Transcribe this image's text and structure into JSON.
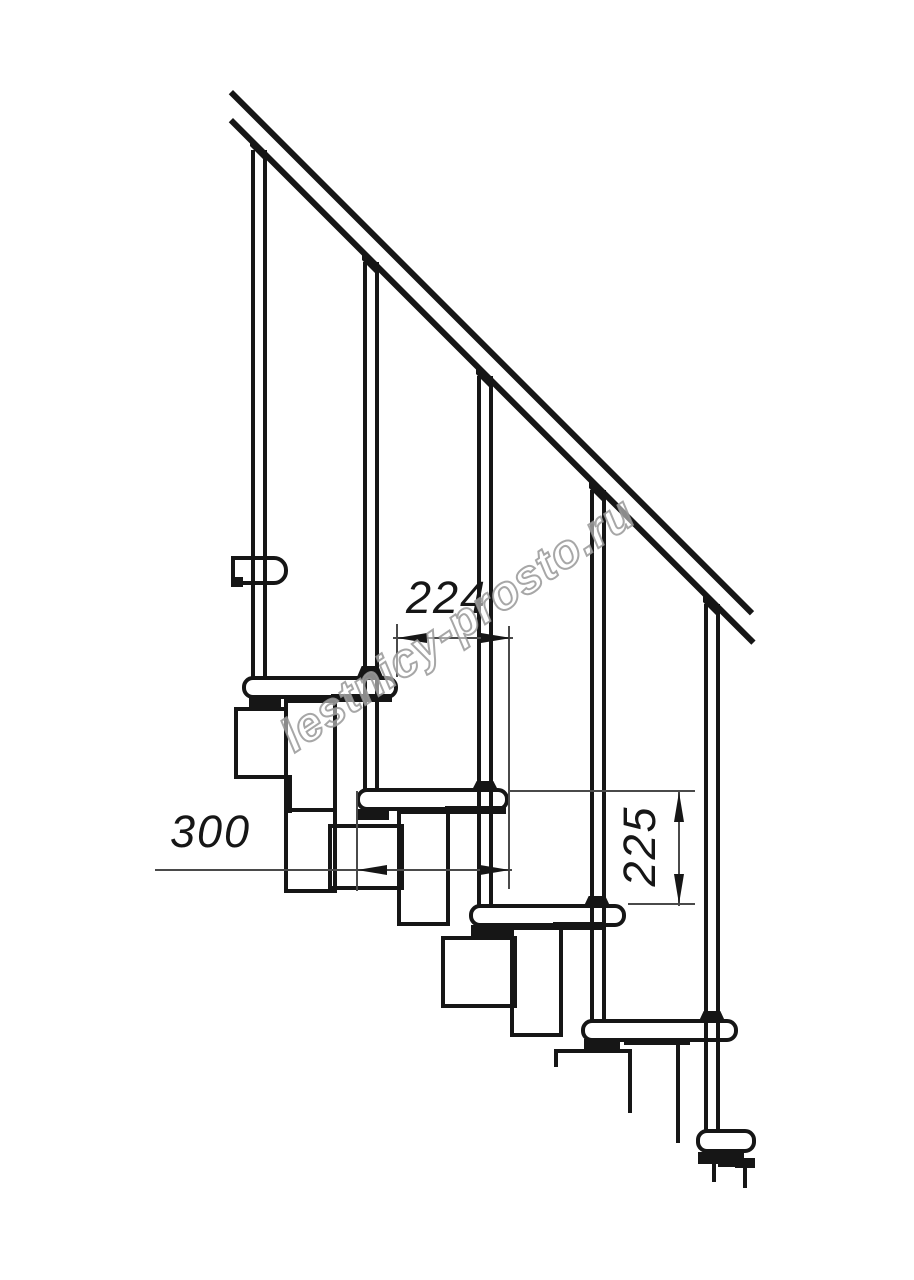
{
  "title": "Modular staircase side elevation drawing",
  "watermark": {
    "text": "lestnicy-prosto.ru",
    "outline_color": "#989898",
    "fill_color": "#ffffff"
  },
  "dimensions": {
    "run_label": "224",
    "depth_label": "300",
    "rise_label": "225",
    "run_meaning": "step run between tread noses (mm)",
    "depth_meaning": "tread depth (mm)",
    "rise_meaning": "step rise between treads (mm)"
  },
  "colors": {
    "ink": "#161616",
    "dim_line": "#4a4a4a",
    "background": "#ffffff"
  },
  "chart_data": {
    "type": "table",
    "title": "Staircase drawing dimensions",
    "categories": [
      "step run",
      "tread depth",
      "step rise"
    ],
    "values": [
      224,
      300,
      225
    ]
  },
  "drawing": {
    "shapes": [
      {
        "n": "handrail-upper-line",
        "t": "line",
        "x": 233,
        "y": 90,
        "w": 737,
        "h": 6,
        "rot": 45
      },
      {
        "n": "handrail-lower-line",
        "t": "line",
        "x": 233,
        "y": 118,
        "w": 739,
        "h": 6,
        "rot": 45
      },
      {
        "n": "baluster-1-left-line",
        "t": "line",
        "x": 251,
        "y": 150,
        "w": 4,
        "h": 527
      },
      {
        "n": "baluster-1-right-line",
        "t": "line",
        "x": 263,
        "y": 150,
        "w": 4,
        "h": 527
      },
      {
        "n": "baluster-2-left-line",
        "t": "line",
        "x": 363,
        "y": 262,
        "w": 4,
        "h": 527
      },
      {
        "n": "baluster-2-right-line",
        "t": "line",
        "x": 375,
        "y": 262,
        "w": 4,
        "h": 527
      },
      {
        "n": "baluster-3-left-line",
        "t": "line",
        "x": 477,
        "y": 376,
        "w": 4,
        "h": 529
      },
      {
        "n": "baluster-3-right-line",
        "t": "line",
        "x": 489,
        "y": 376,
        "w": 4,
        "h": 529
      },
      {
        "n": "baluster-4-left-line",
        "t": "line",
        "x": 590,
        "y": 490,
        "w": 4,
        "h": 530
      },
      {
        "n": "baluster-4-right-line",
        "t": "line",
        "x": 602,
        "y": 490,
        "w": 4,
        "h": 530
      },
      {
        "n": "baluster-5-left-line",
        "t": "line",
        "x": 704,
        "y": 604,
        "w": 4,
        "h": 526
      },
      {
        "n": "baluster-5-right-line",
        "t": "line",
        "x": 716,
        "y": 604,
        "w": 4,
        "h": 526
      },
      {
        "n": "baluster-1-rail-cap",
        "t": "line",
        "x": 250,
        "y": 137,
        "w": 17,
        "h": 9,
        "skew": 45
      },
      {
        "n": "baluster-2-rail-cap",
        "t": "line",
        "x": 362,
        "y": 251,
        "w": 17,
        "h": 9,
        "skew": 45
      },
      {
        "n": "baluster-3-rail-cap",
        "t": "line",
        "x": 476,
        "y": 365,
        "w": 17,
        "h": 9,
        "skew": 45
      },
      {
        "n": "baluster-4-rail-cap",
        "t": "line",
        "x": 589,
        "y": 479,
        "w": 17,
        "h": 9,
        "skew": 45
      },
      {
        "n": "baluster-5-rail-cap",
        "t": "line",
        "x": 703,
        "y": 593,
        "w": 17,
        "h": 9,
        "skew": 45
      },
      {
        "n": "rail-bracket-post1",
        "t": "out",
        "x": 231,
        "y": 556,
        "w": 57,
        "h": 29,
        "r": "0 14px 14px 0"
      },
      {
        "n": "rail-bracket-notch",
        "t": "line",
        "x": 231,
        "y": 577,
        "w": 12,
        "h": 10
      },
      {
        "n": "floor-slab-top-edge",
        "t": "line",
        "x": 234,
        "y": 707,
        "w": 50,
        "h": 4
      },
      {
        "n": "floor-slab-left-edge",
        "t": "line",
        "x": 234,
        "y": 707,
        "w": 4,
        "h": 72
      },
      {
        "n": "floor-slab-bottom-edge",
        "t": "line",
        "x": 234,
        "y": 775,
        "w": 58,
        "h": 4
      },
      {
        "n": "floor-slab-right-edge",
        "t": "line",
        "x": 288,
        "y": 775,
        "w": 4,
        "h": 38
      },
      {
        "n": "tread-1",
        "t": "out",
        "x": 242,
        "y": 676,
        "w": 156,
        "h": 23,
        "r": "11px"
      },
      {
        "n": "tread-2",
        "t": "out",
        "x": 356,
        "y": 788,
        "w": 153,
        "h": 23,
        "r": "11px"
      },
      {
        "n": "tread-3",
        "t": "out",
        "x": 469,
        "y": 904,
        "w": 157,
        "h": 23,
        "r": "11px"
      },
      {
        "n": "tread-4",
        "t": "out",
        "x": 581,
        "y": 1019,
        "w": 157,
        "h": 23,
        "r": "11px"
      },
      {
        "n": "tread-5-bottom",
        "t": "out",
        "x": 696,
        "y": 1129,
        "w": 60,
        "h": 24,
        "r": "11px"
      },
      {
        "n": "module-column-1",
        "t": "out",
        "x": 284,
        "y": 699,
        "w": 53,
        "h": 194
      },
      {
        "n": "module-column-1-joint",
        "t": "line",
        "x": 286,
        "y": 808,
        "w": 49,
        "h": 4
      },
      {
        "n": "module-box-1",
        "t": "out",
        "x": 328,
        "y": 824,
        "w": 76,
        "h": 66
      },
      {
        "n": "module-column-2",
        "t": "out",
        "x": 397,
        "y": 810,
        "w": 53,
        "h": 116
      },
      {
        "n": "module-box-2",
        "t": "out",
        "x": 441,
        "y": 936,
        "w": 76,
        "h": 72
      },
      {
        "n": "module-column-3",
        "t": "out",
        "x": 510,
        "y": 926,
        "w": 53,
        "h": 111
      },
      {
        "n": "module-box-3-top-edge",
        "t": "line",
        "x": 554,
        "y": 1049,
        "w": 78,
        "h": 4
      },
      {
        "n": "module-box-3-right-edge",
        "t": "line",
        "x": 628,
        "y": 1049,
        "w": 4,
        "h": 64
      },
      {
        "n": "module-box-3-left-stub",
        "t": "line",
        "x": 554,
        "y": 1049,
        "w": 4,
        "h": 18
      },
      {
        "n": "module-column-4-right-edge",
        "t": "line",
        "x": 676,
        "y": 1041,
        "w": 4,
        "h": 102
      },
      {
        "n": "clamp-under-tread-1",
        "t": "line",
        "x": 249,
        "y": 697,
        "w": 32,
        "h": 11
      },
      {
        "n": "nut-under-tread-1",
        "t": "line",
        "x": 331,
        "y": 694,
        "w": 61,
        "h": 8
      },
      {
        "n": "clamp-under-tread-2",
        "t": "line",
        "x": 356,
        "y": 809,
        "w": 33,
        "h": 11
      },
      {
        "n": "nut-under-tread-2",
        "t": "line",
        "x": 445,
        "y": 806,
        "w": 61,
        "h": 8
      },
      {
        "n": "clamp-under-tread-3",
        "t": "line",
        "x": 471,
        "y": 925,
        "w": 41,
        "h": 11
      },
      {
        "n": "nut-under-tread-3",
        "t": "line",
        "x": 553,
        "y": 922,
        "w": 52,
        "h": 8
      },
      {
        "n": "clamp-under-tread-4",
        "t": "line",
        "x": 584,
        "y": 1039,
        "w": 36,
        "h": 11
      },
      {
        "n": "nut-under-tread-4",
        "t": "line",
        "x": 624,
        "y": 1038,
        "w": 66,
        "h": 7
      },
      {
        "n": "clamp-under-tread-5",
        "t": "line",
        "x": 698,
        "y": 1152,
        "w": 46,
        "h": 12
      },
      {
        "n": "floor-anchor-step",
        "t": "line",
        "x": 735,
        "y": 1158,
        "w": 20,
        "h": 10
      },
      {
        "n": "floor-anchor-stub-left",
        "t": "line",
        "x": 712,
        "y": 1162,
        "w": 4,
        "h": 20
      },
      {
        "n": "floor-anchor-hline",
        "t": "line",
        "x": 718,
        "y": 1164,
        "w": 28,
        "h": 3
      },
      {
        "n": "floor-anchor-stub-right",
        "t": "line",
        "x": 743,
        "y": 1164,
        "w": 4,
        "h": 24
      },
      {
        "n": "bolt-cap-tread-1",
        "t": "line",
        "x": 357,
        "y": 666,
        "w": 26,
        "h": 11,
        "clip": "polygon(18% 0, 82% 0, 100% 100%, 0 100%)"
      },
      {
        "n": "bolt-cap-tread-2",
        "t": "line",
        "x": 472,
        "y": 781,
        "w": 26,
        "h": 9,
        "clip": "polygon(18% 0, 82% 0, 100% 100%, 0 100%)"
      },
      {
        "n": "bolt-cap-tread-3",
        "t": "line",
        "x": 584,
        "y": 896,
        "w": 26,
        "h": 10,
        "clip": "polygon(18% 0, 82% 0, 100% 100%, 0 100%)"
      },
      {
        "n": "bolt-cap-tread-4",
        "t": "line",
        "x": 699,
        "y": 1011,
        "w": 26,
        "h": 10,
        "clip": "polygon(18% 0, 82% 0, 100% 100%, 0 100%)"
      },
      {
        "n": "dim-run-extension-left",
        "t": "thin",
        "x": 396,
        "y": 624,
        "w": 2,
        "h": 53
      },
      {
        "n": "dim-run-extension-right",
        "t": "thin",
        "x": 508,
        "y": 626,
        "w": 2,
        "h": 263
      },
      {
        "n": "dim-run-line",
        "t": "thin",
        "x": 393,
        "y": 637,
        "w": 120,
        "h": 2
      },
      {
        "n": "dim-run-arrow-left",
        "t": "arr",
        "dir": "left",
        "x": 397,
        "y": 638
      },
      {
        "n": "dim-run-arrow-right",
        "t": "arr",
        "dir": "right",
        "x": 511,
        "y": 638
      },
      {
        "n": "dim-depth-line",
        "t": "thin",
        "x": 155,
        "y": 869,
        "w": 357,
        "h": 2
      },
      {
        "n": "dim-depth-extension",
        "t": "thin",
        "x": 356,
        "y": 791,
        "w": 2,
        "h": 100
      },
      {
        "n": "dim-depth-arrow-left",
        "t": "arr",
        "dir": "left",
        "x": 357,
        "y": 870
      },
      {
        "n": "dim-depth-arrow-right",
        "t": "arr",
        "dir": "right",
        "x": 510,
        "y": 870
      },
      {
        "n": "dim-rise-extension-top",
        "t": "thin",
        "x": 510,
        "y": 790,
        "w": 185,
        "h": 2
      },
      {
        "n": "dim-rise-extension-bottom",
        "t": "thin",
        "x": 628,
        "y": 903,
        "w": 67,
        "h": 2
      },
      {
        "n": "dim-rise-line",
        "t": "thin",
        "x": 678,
        "y": 791,
        "w": 2,
        "h": 115
      },
      {
        "n": "dim-rise-arrow-up",
        "t": "arr",
        "dir": "up",
        "x": 679,
        "y": 792
      },
      {
        "n": "dim-rise-arrow-down",
        "t": "arr",
        "dir": "down",
        "x": 679,
        "y": 904
      }
    ]
  }
}
